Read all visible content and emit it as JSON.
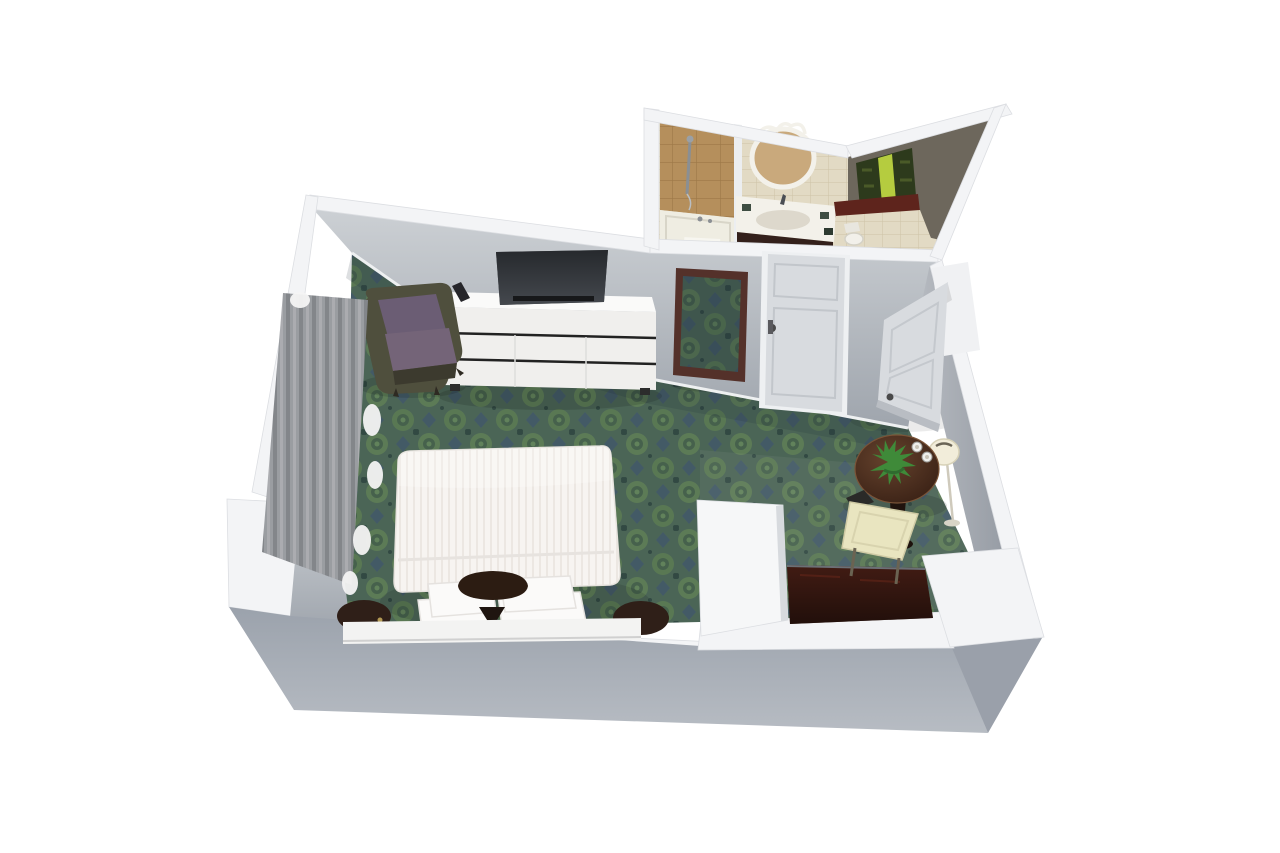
{
  "scene": {
    "description": "3D rendered top-down cutaway floor plan of a hotel guest room with bedroom, bathroom and entry hall",
    "view": "isometric top-down cutaway",
    "background": "#ffffff"
  },
  "colors": {
    "carpet_base": "#4b6556",
    "carpet_motif_light": "#5e7d56",
    "carpet_motif_blue": "#40566b",
    "carpet_dot": "#2f4641",
    "wall_top": "#f3f4f6",
    "wall_outer": "#9aa1ab",
    "wall_inner_light": "#ccd0d4",
    "wall_inner_dark": "#9fa5ad",
    "tile_floor": "#e2dac4",
    "tile_line": "#cdc3a6",
    "shower_tile": "#b58f5c",
    "tub_white": "#efede2",
    "vanity_counter": "#f3f1ea",
    "vanity_cabinet": "#33201b",
    "wc_wall": "#6d675c",
    "art_dark": "#2d3a1c",
    "art_bright": "#b5cc3f",
    "ledge_red": "#5e241c",
    "bed_white": "#f7f4f1",
    "pillow_white": "#fbfaf9",
    "accent_pillow": "#2c1c12",
    "headboard": "#f3f3f2",
    "nightstand": "#2f1f18",
    "dresser": "#f0efed",
    "tv_dark": "#2e3135",
    "chair_purple": "#6b5d74",
    "chair_frame": "#4f4f3d",
    "mirror_frame": "#54312a",
    "door_white": "#d8dbdf",
    "table_wood": "#47291c",
    "plant_green": "#3f8a39",
    "chair_cream": "#e9e5c0",
    "lamp_shade": "#f2edda",
    "cabinet_dark": "#31150f",
    "curtain_gray": "#a9acb0"
  },
  "rooms": {
    "bedroom": {
      "label": "Bedroom"
    },
    "bathroom": {
      "label": "Bathroom"
    },
    "entry": {
      "label": "Entry hall"
    },
    "alcove": {
      "label": "Closet alcove"
    }
  },
  "furniture": {
    "carpet": {
      "label": "Green damask carpet"
    },
    "bed": {
      "label": "King bed with white striped duvet"
    },
    "accent_pillow": {
      "label": "Dark accent cushion"
    },
    "headboard": {
      "label": "White headboard"
    },
    "nightstand_left": {
      "label": "Round dark wood nightstand (left)"
    },
    "nightstand_right": {
      "label": "Round dark wood nightstand (right)"
    },
    "armchair": {
      "label": "Purple wingback armchair"
    },
    "dresser": {
      "label": "White six-drawer TV dresser"
    },
    "tv": {
      "label": "Flat-screen TV"
    },
    "remote": {
      "label": "TV remote"
    },
    "leaning_mirror": {
      "label": "Leaning floor mirror"
    },
    "bathroom_door": {
      "label": "Bathroom door (closed)"
    },
    "entry_door": {
      "label": "Entry door (open)"
    },
    "curtains": {
      "label": "Gray window drapes with sheer curtains"
    },
    "bathtub": {
      "label": "Bathtub"
    },
    "shower": {
      "label": "Shower fixture on tiled wall"
    },
    "vanity": {
      "label": "Vanity sink with oval mirror"
    },
    "toilet": {
      "label": "Toilet"
    },
    "wall_art": {
      "label": "Green wall art"
    },
    "ledge": {
      "label": "Dark red ledge"
    },
    "table": {
      "label": "Round dark wood side table"
    },
    "plant": {
      "label": "Green plant on table"
    },
    "cups": {
      "label": "Coffee cups"
    },
    "lamp": {
      "label": "Floor lamp"
    },
    "side_chair": {
      "label": "Cream upholstered chair"
    },
    "cabinet": {
      "label": "Dark wood cabinet in alcove"
    }
  }
}
